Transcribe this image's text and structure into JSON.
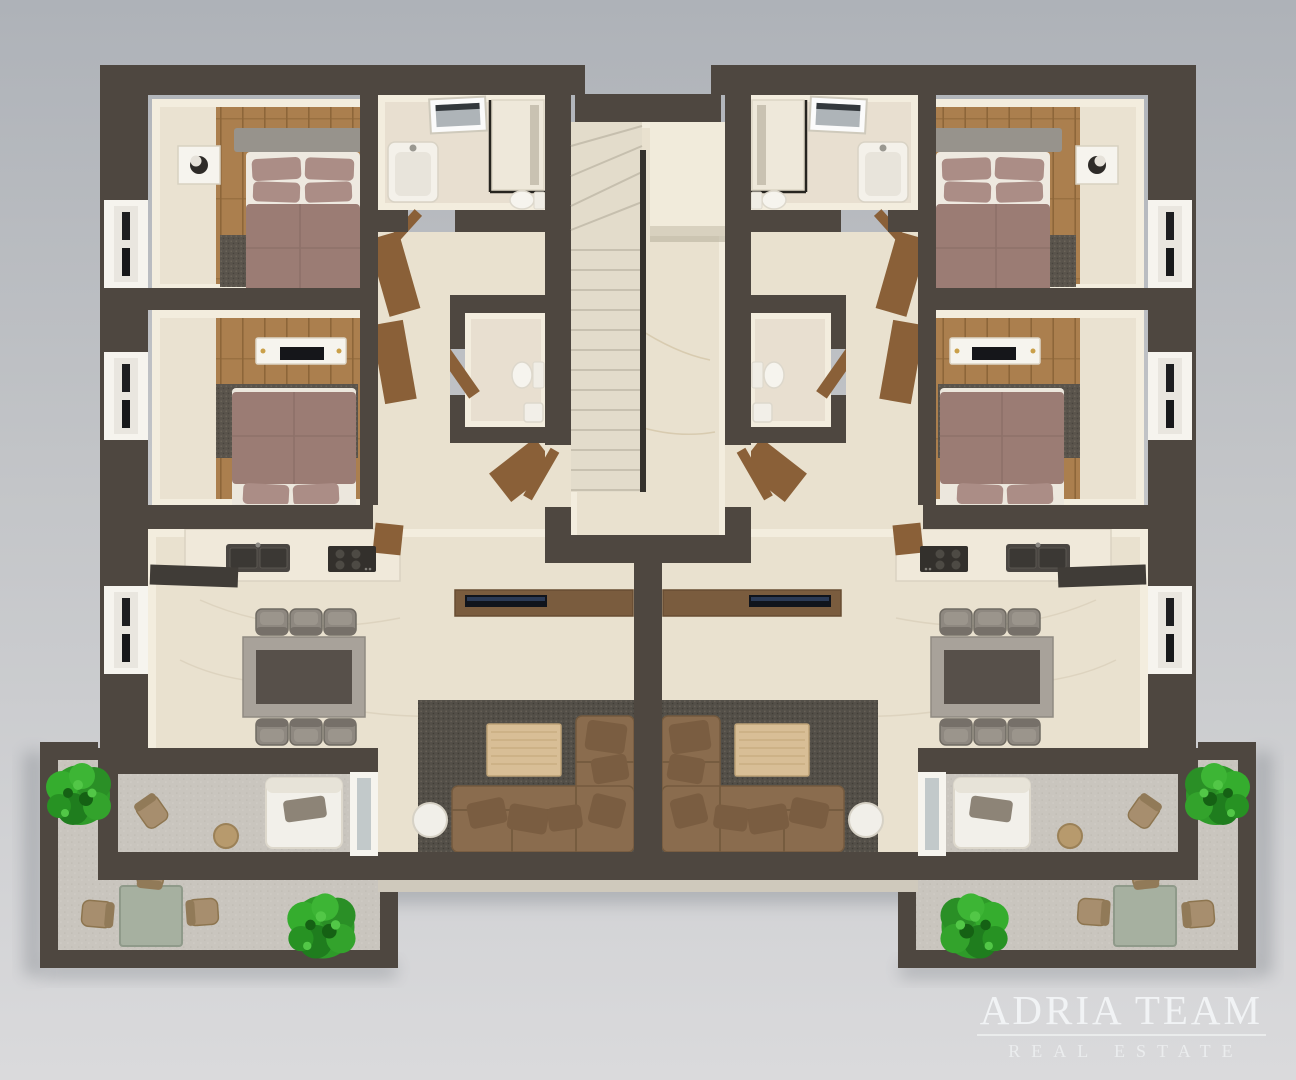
{
  "watermark": {
    "line1": "ADRIA TEAM",
    "line2": "REAL ESTATE"
  },
  "palette": {
    "bg_top": "#aeb2b8",
    "bg_bottom": "#dadadc",
    "wall": "#4e4740",
    "floor_cream": "#eae2d1",
    "floor_light": "#f3edde",
    "marble": "#e9e1cf",
    "tile": "#e8dfd0",
    "wood_floor": "#ab7f4e",
    "wood_furniture": "#8a6038",
    "white_frame": "#f6f4ee",
    "counter": "#f0e9da",
    "appliance_dark": "#3a3733",
    "bed_mauve": "#9b7c74",
    "bed_pillow": "#ab8d86",
    "headboard": "#97938c",
    "sofa_brown": "#8a6c4e",
    "sofa_pillow": "#7a5d41",
    "coffee_table": "#d8be96",
    "dining_top": "#57504a",
    "dining_frame": "#a8a29a",
    "rug_living": "#534f48",
    "rug_bedroom": "#5a544c",
    "concrete": "#c9c5be",
    "outdoor_table": "#a6b0a0",
    "outdoor_chair": "#a78e6e",
    "lounge_white": "#f2f0ea",
    "bush_green": "#2e9b29",
    "watermark": "rgba(246,248,249,0.85)"
  },
  "floorplan": {
    "render_type": "3d-top-down-floor-plan",
    "shared": {
      "staircase": [
        "winder-stairs",
        "straight-stairs",
        "metal-railing",
        "upper-landing-platform",
        "marble-lobby",
        "entry-door-left-unit",
        "entry-door-right-unit"
      ]
    },
    "units": [
      {
        "side": "left",
        "mirrored": false
      },
      {
        "side": "right",
        "mirrored": true
      }
    ],
    "rooms_per_unit": [
      {
        "name": "bedroom-1",
        "furniture": [
          "double-bed",
          "mauve-bedding",
          "gray-headboard",
          "nightstand",
          "lamp",
          "gray-rug",
          "wood-floor",
          "window"
        ]
      },
      {
        "name": "bedroom-2",
        "furniture": [
          "double-bed",
          "mauve-bedding",
          "wall-tv-shelf",
          "tv",
          "gray-rug",
          "wood-floor",
          "window"
        ]
      },
      {
        "name": "bathroom",
        "furniture": [
          "skylight",
          "washbasin",
          "glass-shower",
          "toilet"
        ]
      },
      {
        "name": "wc",
        "furniture": [
          "toilet",
          "small-washbasin",
          "wood-door"
        ]
      },
      {
        "name": "hallway",
        "furniture": [
          "wardrobe-panels",
          "wood-desk",
          "marble-floor"
        ]
      },
      {
        "name": "kitchen-dining-living",
        "furniture": [
          "kitchen-counter",
          "double-sink",
          "cooktop",
          "dining-table",
          "six-chairs",
          "tv-sideboard",
          "tv",
          "l-shaped-sofa",
          "coffee-table",
          "round-side-table",
          "area-rug",
          "window"
        ]
      },
      {
        "name": "covered-balcony",
        "furniture": [
          "lounge-daybed",
          "outdoor-chair",
          "side-stool",
          "glass-door"
        ]
      },
      {
        "name": "terrace",
        "furniture": [
          "outdoor-dining-table",
          "outdoor-chairs",
          "green-bush-top",
          "green-bush-bottom",
          "concrete-floor",
          "parapet-walls"
        ]
      }
    ]
  }
}
